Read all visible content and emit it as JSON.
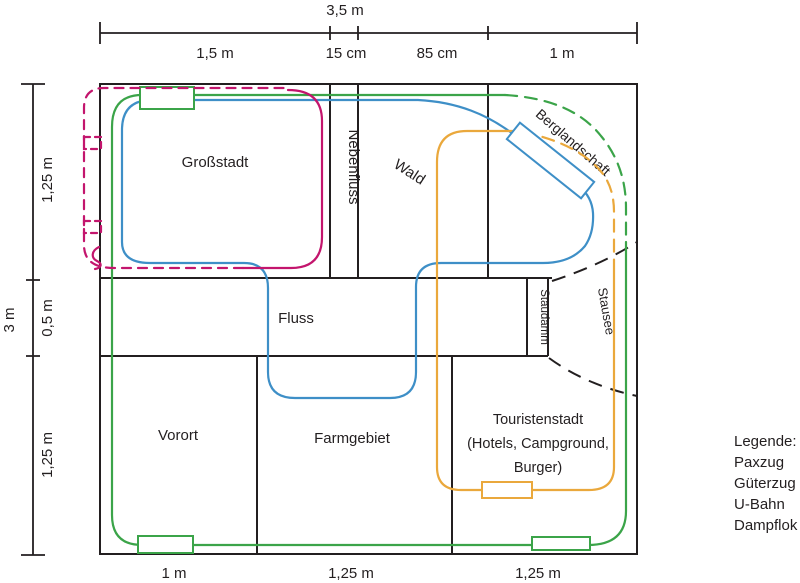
{
  "diagram": {
    "regions": {
      "grossstadt": "Großstadt",
      "nebenfluss": "Nebenfluss",
      "wald": "Wald",
      "berglandschaft": "Berglandschaft",
      "fluss": "Fluss",
      "staudamm": "Staudamm",
      "stausee": "Stausee",
      "vorort": "Vorort",
      "farmgebiet": "Farmgebiet",
      "touristenstadt": {
        "line1": "Touristenstadt",
        "line2": "(Hotels, Campground,",
        "line3": "Burger)"
      }
    },
    "dimensions": {
      "top": {
        "total": "3,5 m",
        "segments": [
          "1,5 m",
          "15 cm",
          "85 cm",
          "1 m"
        ]
      },
      "left": {
        "total": "3 m",
        "segments": [
          "1,25 m",
          "0,5 m",
          "1,25 m"
        ]
      },
      "bottom": {
        "segments": [
          "1 m",
          "1,25 m",
          "1,25 m"
        ]
      }
    },
    "outline_color": "#231f20"
  },
  "tracks": {
    "paxzug": {
      "label": "Paxzug",
      "color": "#3ba449"
    },
    "gueterzug": {
      "label": "Güterzug",
      "color": "#3e8fc7"
    },
    "ubahn": {
      "label": "U-Bahn",
      "color": "#c3156d"
    },
    "dampflok": {
      "label": "Dampflok",
      "color": "#eaa83c"
    }
  },
  "legend": {
    "title": "Legende:"
  }
}
